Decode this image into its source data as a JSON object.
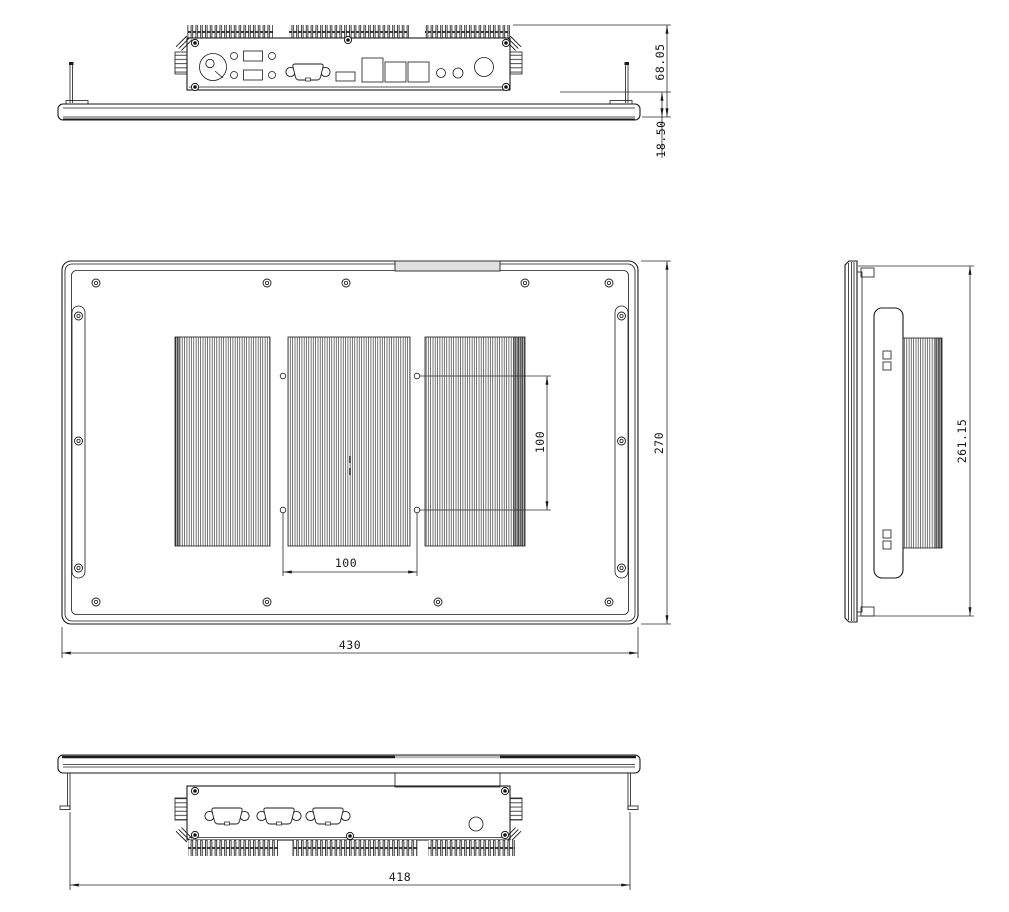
{
  "drawing": {
    "background": "#ffffff",
    "line_color": "#1a1a1a",
    "tab_fill": "#e0e0e0",
    "dimensions": {
      "top_view_total_height": "68.05",
      "top_view_panel_thickness": "18.50",
      "rear_view_width": "430",
      "rear_view_height": "270",
      "vesa_vertical_spacing": "100",
      "vesa_horizontal_spacing": "100",
      "side_view_height": "261.15",
      "bottom_view_mount_width": "418"
    }
  }
}
